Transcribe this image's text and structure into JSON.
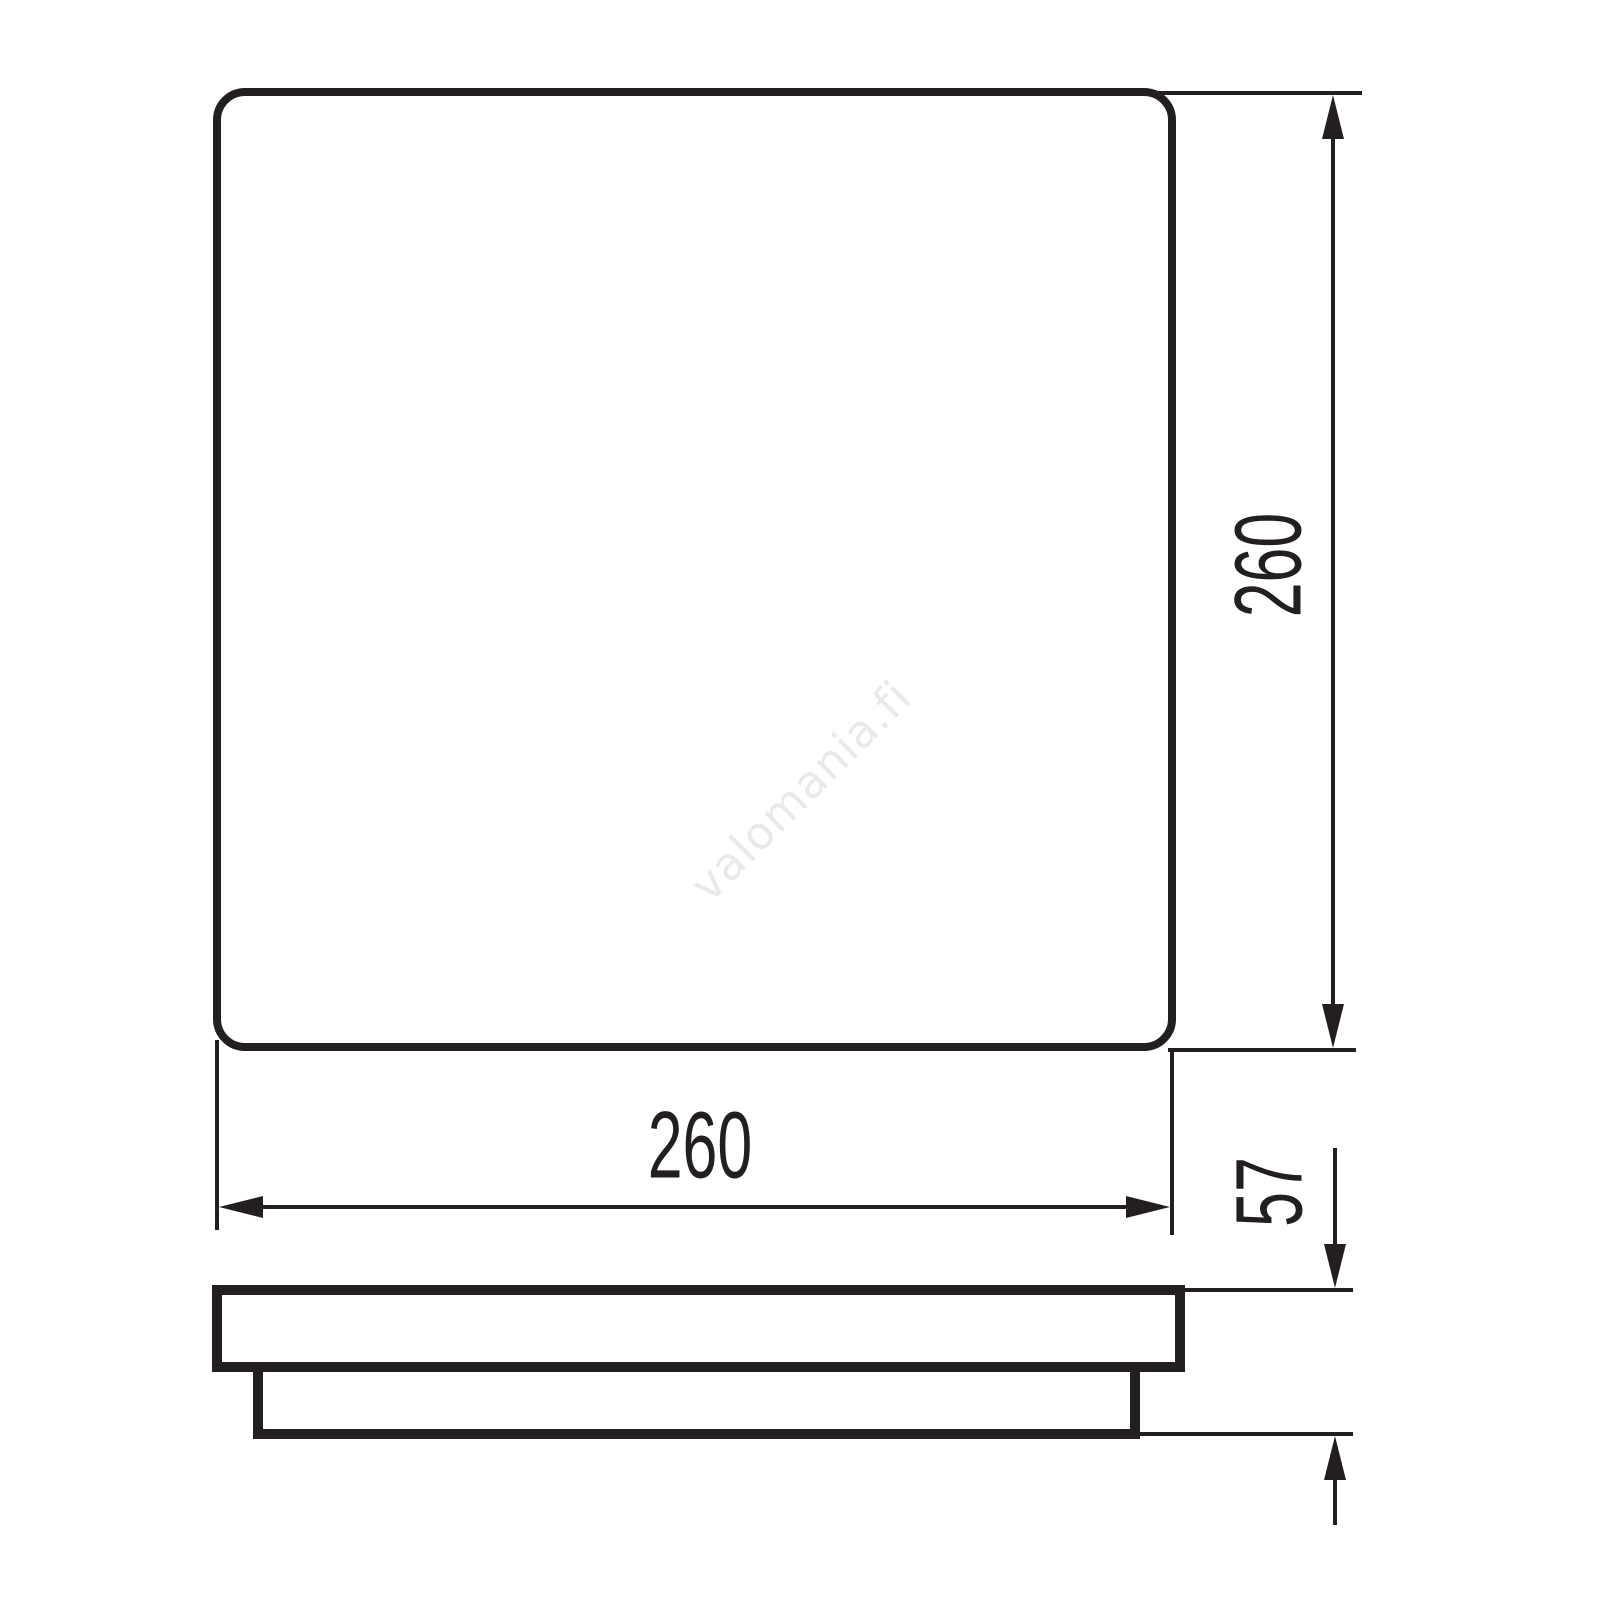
{
  "colors": {
    "line": "#231f20",
    "watermark": "#e9e9e9",
    "background": "#ffffff"
  },
  "drawing": {
    "dimensions": {
      "width": "260",
      "height": "260",
      "depth": "57"
    }
  },
  "watermark": {
    "text": "valomania.fi"
  }
}
